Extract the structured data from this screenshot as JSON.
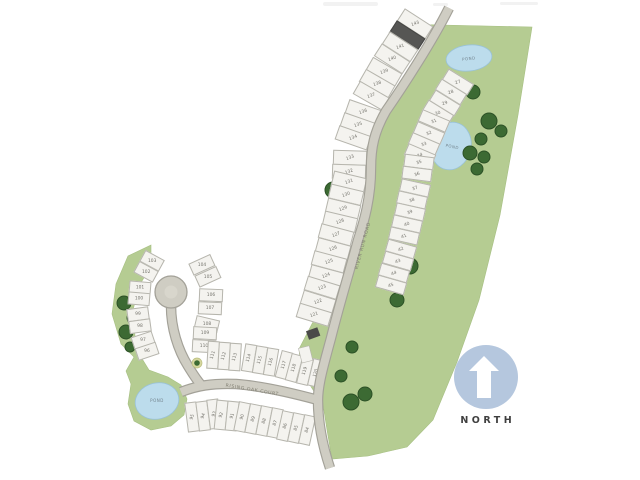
{
  "map": {
    "north_label": "NORTH",
    "roads": [
      {
        "id": "river-run",
        "name": "RIVER RUN ROAD"
      },
      {
        "id": "rising-oak",
        "name": "RISING OAK COURT"
      }
    ],
    "ponds": [
      {
        "id": "pond-north",
        "label": "POND"
      },
      {
        "id": "pond-mid",
        "label": "POND"
      },
      {
        "id": "pond-west",
        "label": "POND"
      }
    ],
    "lot_rows": [
      {
        "id": "main-left",
        "numbers": [
          "143",
          "142",
          "141",
          "140",
          "139",
          "138",
          "137",
          "136",
          "135",
          "134",
          "133",
          "132",
          "131",
          "130",
          "129",
          "128",
          "127",
          "126",
          "125",
          "124",
          "123",
          "122",
          "121"
        ],
        "sold": [
          "142"
        ]
      },
      {
        "id": "main-right",
        "numbers": [
          "27",
          "28",
          "29",
          "30",
          "31",
          "32",
          "33",
          "34",
          "35",
          "36",
          "37",
          "38",
          "39",
          "40",
          "41",
          "42",
          "43",
          "44",
          "45"
        ],
        "sold": []
      },
      {
        "id": "culdesac-left",
        "numbers": [
          "103",
          "102",
          "101",
          "100",
          "99",
          "98",
          "97",
          "96"
        ],
        "sold": []
      },
      {
        "id": "culdesac-right",
        "numbers": [
          "104",
          "105",
          "106",
          "107",
          "108",
          "109",
          "110"
        ],
        "sold": []
      },
      {
        "id": "court-upper",
        "numbers": [
          "111",
          "112",
          "113",
          "114",
          "115",
          "116",
          "117",
          "118",
          "119",
          "120"
        ],
        "sold": []
      },
      {
        "id": "court-lower",
        "numbers": [
          "95",
          "94",
          "93",
          "92",
          "91",
          "90",
          "89",
          "88",
          "87",
          "86",
          "85",
          "84"
        ],
        "sold": []
      }
    ]
  },
  "colors": {
    "green": "#b5cc92",
    "green_edge": "#a6bf82",
    "tree": "#3c6a33",
    "tree_edge": "#2c5126",
    "pond": "#bcdcec",
    "pond_edge": "#99c2d8",
    "pond_label": "#74858f",
    "road_fill": "#cfcdc3",
    "road_edge": "#a3a198",
    "road_inner": "#d8d6cc",
    "road_label": "#807f72",
    "lot_fill": "#f4f3ef",
    "lot_edge": "#b6b5ad",
    "lot_sold": "#565654",
    "lot_number": "#74736c",
    "structure": "#4a4a48",
    "marker_base": "#d6d79e",
    "north_circle": "#b5c7de",
    "north_arrow": "#ffffff",
    "north_text": "#3f3f3f"
  }
}
